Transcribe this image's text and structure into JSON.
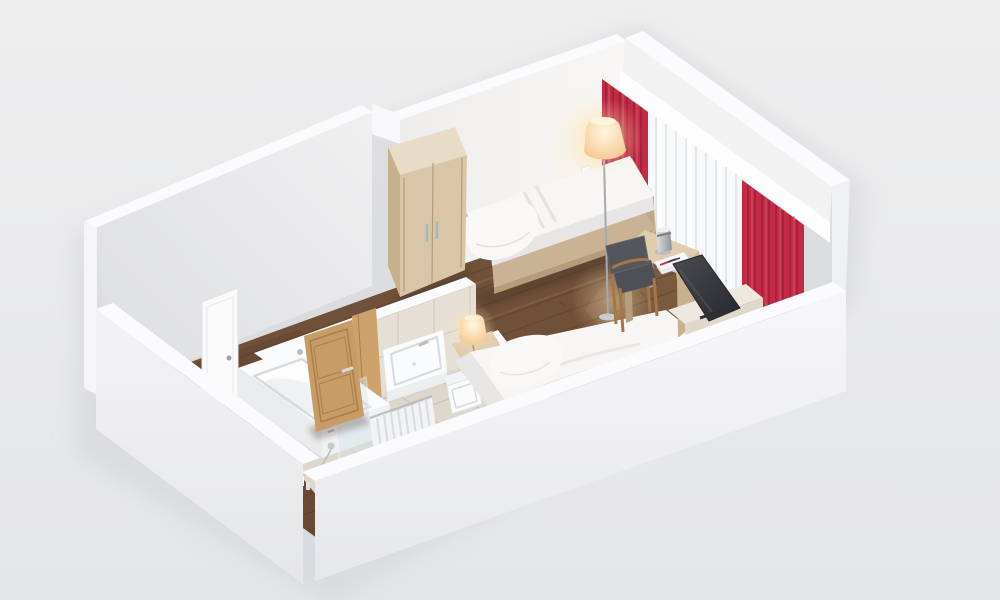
{
  "scene": {
    "description": "3D isometric cutaway floor plan render of a hotel guest room",
    "areas": [
      "bedroom",
      "bathroom",
      "entry corridor"
    ],
    "furniture": [
      "wardrobe",
      "single-bed-1",
      "single-bed-2",
      "floor-lamp",
      "bedside-lamp",
      "desk",
      "desk-lamp",
      "magazines",
      "chair",
      "tv",
      "tv-cabinet",
      "nightstand-shelf"
    ],
    "bathroom_fixtures": [
      "bathtub",
      "shower-glass-screen",
      "hand-shower",
      "washbasin",
      "wall-hung-toilet",
      "radiator",
      "open-wooden-door"
    ],
    "window_treatment": "red drapes with white sheer curtains under white pelmet"
  },
  "palette": {
    "background": "#e9eaeb",
    "wall_white": "#f2f2f3",
    "wall_top": "#fbfbfd",
    "pelmet": "#fdfdfe",
    "corner_strip": "#eff0f2",
    "cap_white": "#f5f5f7",
    "seam_white": "#f8f8fa",
    "wood_floor": "#6f5038",
    "wood_floor_dark": "#54392a",
    "wood_floor_light": "#8f6c4e",
    "tile_floor": "#ddd7ce",
    "tile_grout": "#c8c1b7",
    "tile_wall": "#e6dfd6",
    "curtain_red": "#c22a45",
    "curtain_red_dark": "#8e1c30",
    "curtain_red_light": "#d85a6e",
    "sheer": "#f8f9fa",
    "sheer_streak": "#dfe2e6",
    "linen": "#f7f6f5",
    "linen_shadow": "#e7e6e5",
    "pillow": "#f9f8f7",
    "bed_base_wood": "#c9b394",
    "headboard_wood": "#d6c3a4",
    "wardrobe_front": "#d9c6a8",
    "wardrobe_side": "#c6b08e",
    "wardrobe_top": "#e9dcc6",
    "desk_top": "#e0ccaf",
    "desk_edge": "#cdb795",
    "desk_side": "#c8b190",
    "desk_leg": "#b79e7d",
    "chair_wood": "#a5764a",
    "chair_fabric": "#54565c",
    "chair_seat": "#4e5055",
    "tv_dark": "#33353a",
    "cabinet_top": "#eee8df",
    "cabinet_front": "#e0d8cb",
    "door_wood": "#c79c66",
    "door_wood_dark": "#aa7f4c",
    "jamb_wood": "#cda26c",
    "chrome": "#b9bdc2",
    "ceramic": "#fafbfc",
    "ceramic_shadow": "#d8dadd",
    "tub_face": "#eef0f1",
    "radiator": "#f2f3f4",
    "radiator_fin": "#d9dcdf",
    "glass": "#d7e4ec",
    "shadow": "#3f2d20",
    "ground_shadow": "#d2d3d6"
  }
}
